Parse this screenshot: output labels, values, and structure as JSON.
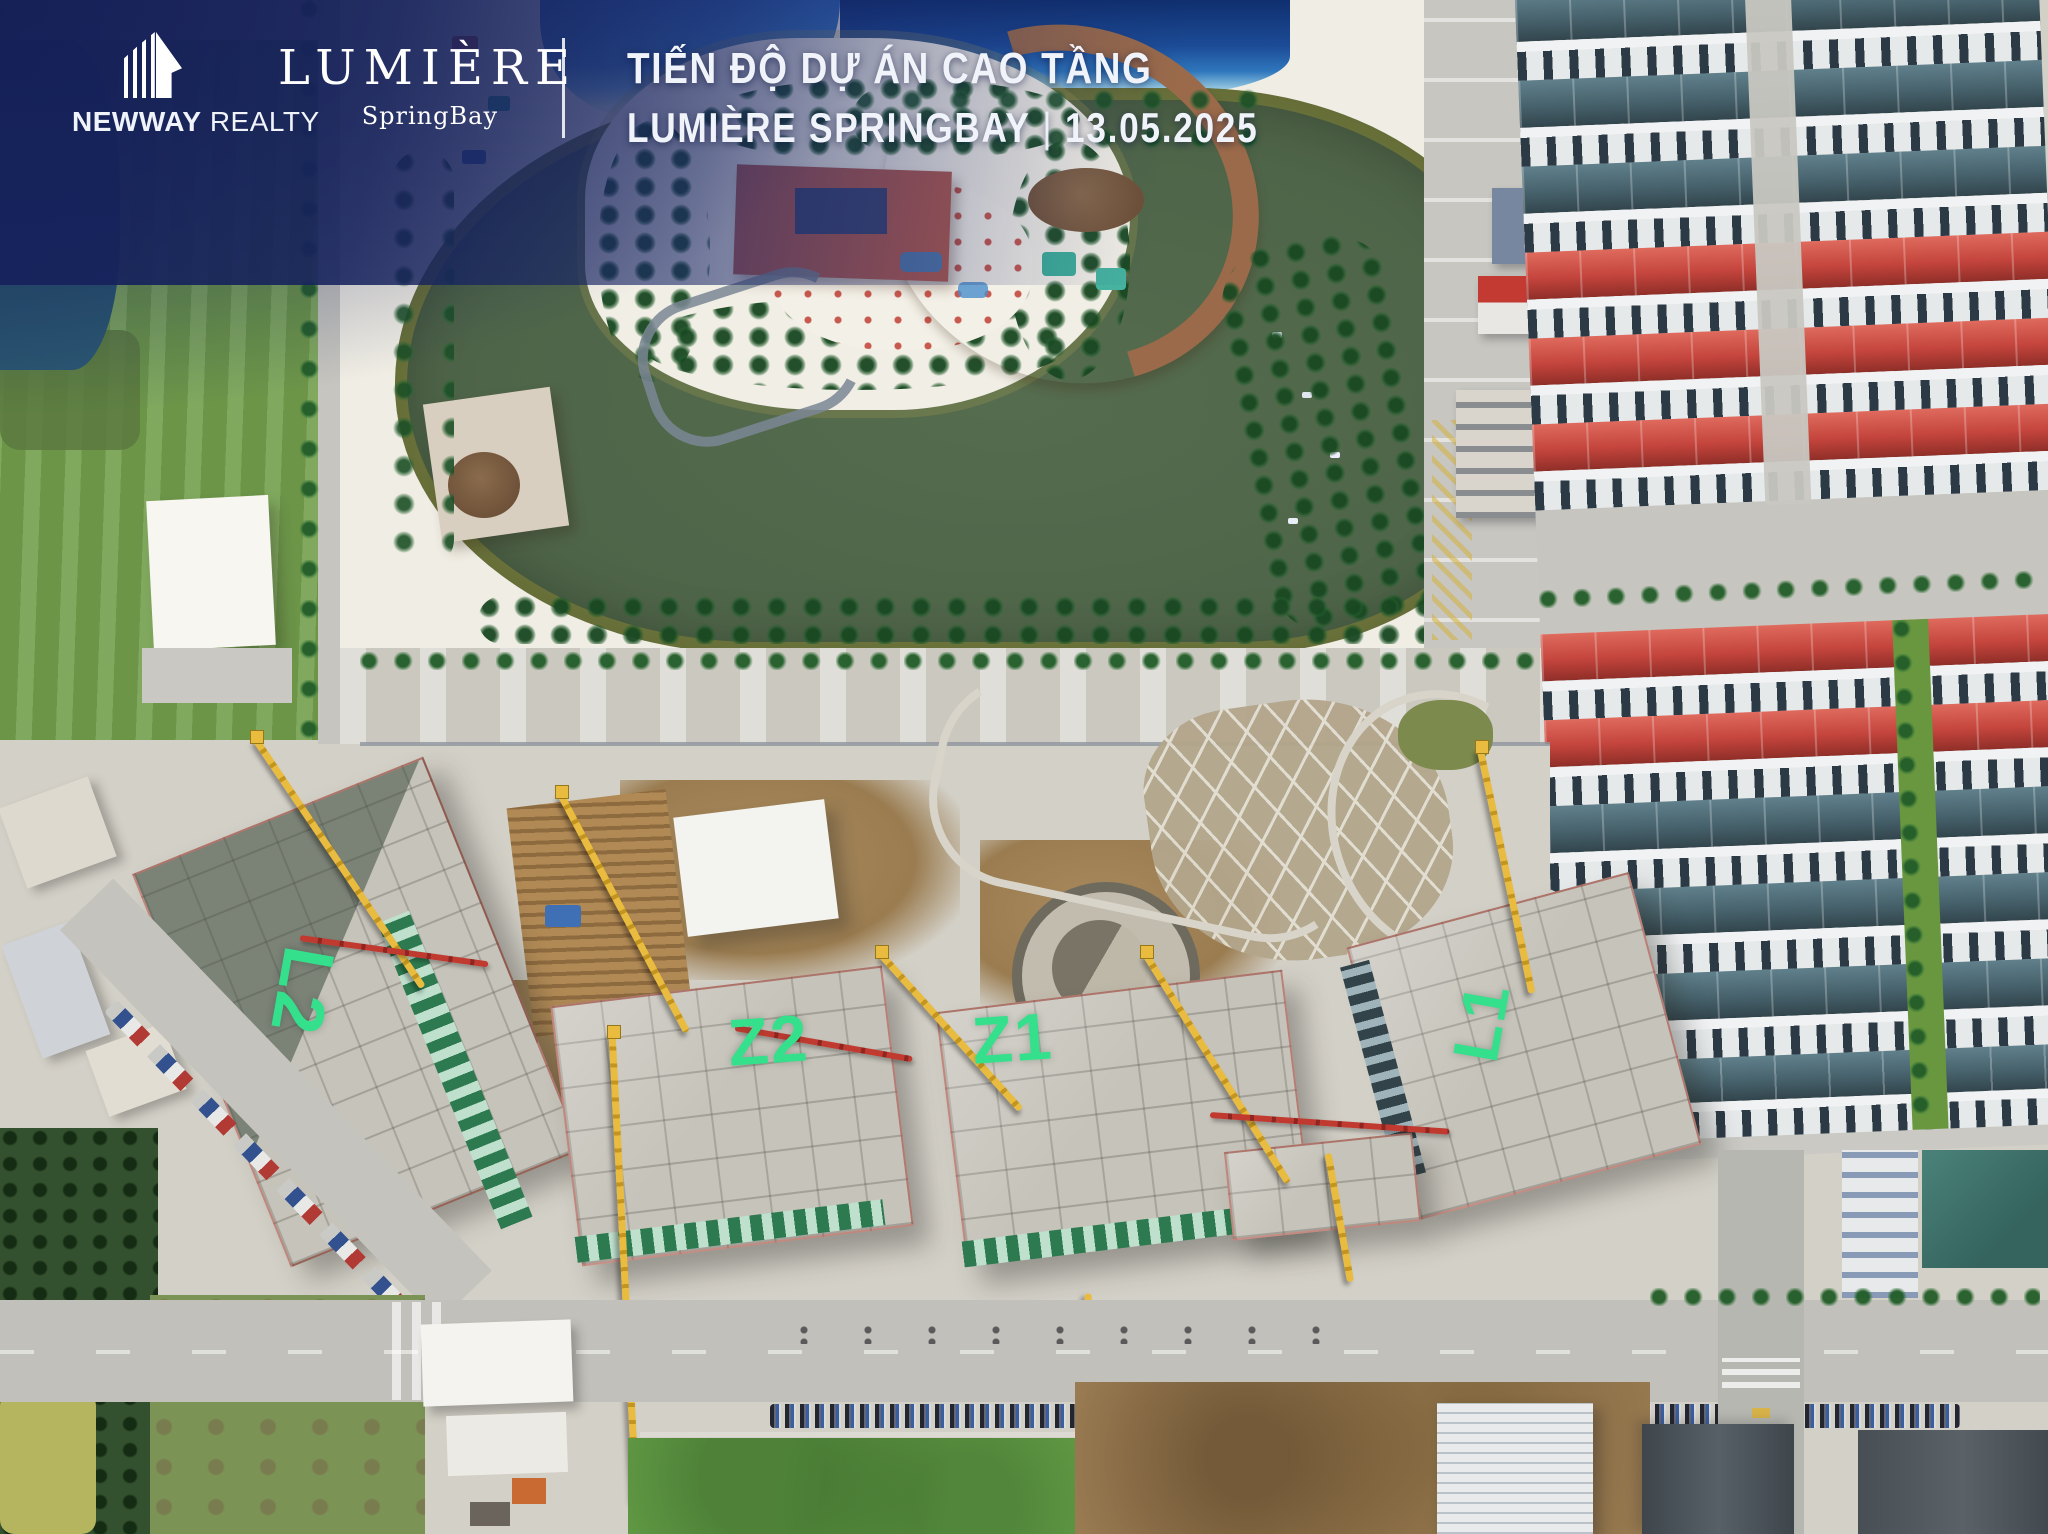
{
  "branding": {
    "newway": {
      "bold": "NEWWAY",
      "light": "REALTY"
    },
    "lumiere": {
      "wordmark": "LUMIÈRE",
      "subbrand": "SpringBay"
    }
  },
  "title": {
    "line1": "TIẾN ĐỘ DỰ ÁN CAO TẦNG",
    "project_name": "LUMIÈRE SPRINGBAY",
    "separator": "|",
    "date": "13.05.2025"
  },
  "site_labels": [
    {
      "id": "L2",
      "text": "L2"
    },
    {
      "id": "Z2",
      "text": "Z2"
    },
    {
      "id": "Z1",
      "text": "Z1"
    },
    {
      "id": "L1",
      "text": "L1"
    }
  ],
  "colors": {
    "label_green": "#34e08c",
    "overlay_navy": "#1b2a6e",
    "lagoon_water": "#4f6549",
    "roof_red": "#c4453d",
    "roof_teal": "#47626c"
  }
}
